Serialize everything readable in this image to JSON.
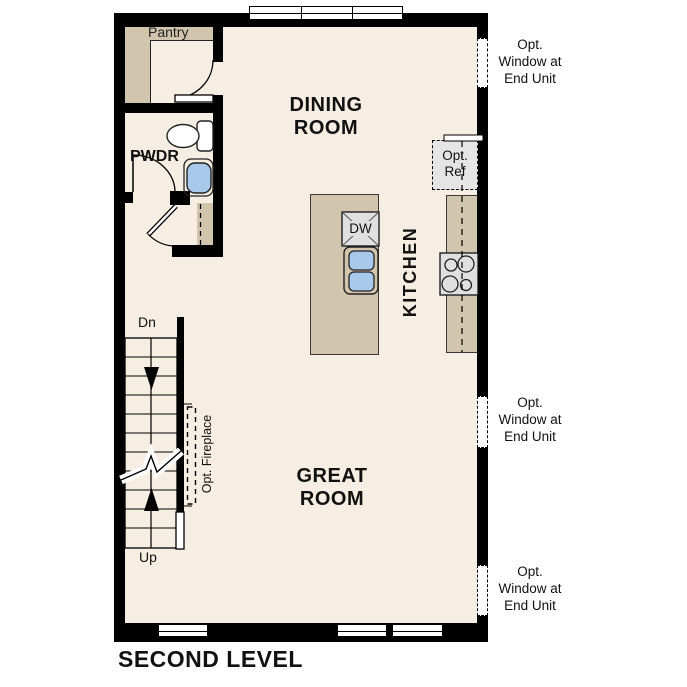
{
  "title": "SECOND LEVEL",
  "rooms": {
    "pantry": "Pantry",
    "powder": "PWDR",
    "dining_line1": "DINING",
    "dining_line2": "ROOM",
    "kitchen": "KITCHEN",
    "great_line1": "GREAT",
    "great_line2": "ROOM"
  },
  "labels": {
    "dw": "DW",
    "ref_line1": "Opt.",
    "ref_line2": "Ref",
    "fireplace": "Opt. Fireplace",
    "stairs_down": "Dn",
    "stairs_up": "Up",
    "opt_window_line1": "Opt.",
    "opt_window_line2": "Window at",
    "opt_window_line3": "End Unit"
  },
  "colors": {
    "wall": "#000000",
    "floor": "#f6eee2",
    "cabinet": "#d2c5ae",
    "appliance": "#e0e0e0",
    "sink": "#a8c9e9",
    "window": "#ffffff"
  }
}
